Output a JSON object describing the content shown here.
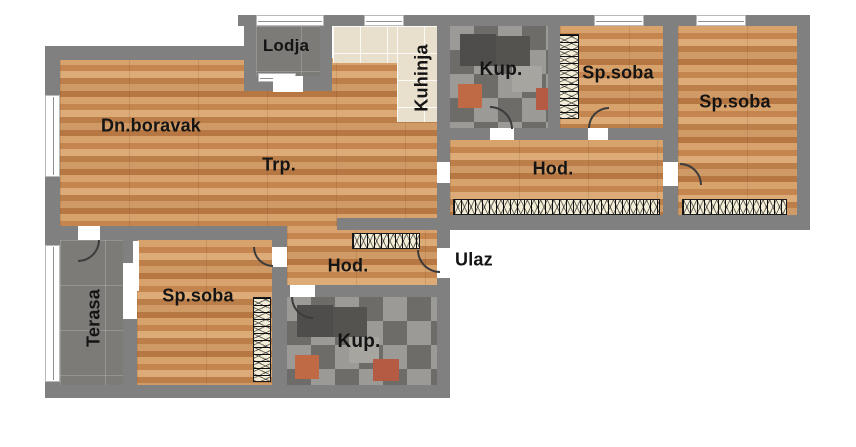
{
  "floorplan": {
    "labels": {
      "dn_boravak": "Dn.boravak",
      "trp": "Trp.",
      "lodja": "Lodja",
      "kuhinja": "Kuhinja",
      "kup_top": "Kup.",
      "sp_soba_top": "Sp.soba",
      "sp_soba_right": "Sp.soba",
      "hod_top": "Hod.",
      "hod_bottom": "Hod.",
      "kup_bottom": "Kup.",
      "sp_soba_bottom": "Sp.soba",
      "terasa": "Terasa",
      "ulaz": "Ulaz"
    },
    "colors": {
      "wall": "#808080",
      "wood_floor": "#cb9260",
      "dark_tile": "#7d7b78",
      "kitchen_tile": "#e8e0cc",
      "mosaic_base": "#8a8886",
      "mosaic_accent": "#c06a45",
      "wardrobe_fill": "#f4eed9",
      "label_text": "#141414",
      "background": "#ffffff"
    }
  }
}
